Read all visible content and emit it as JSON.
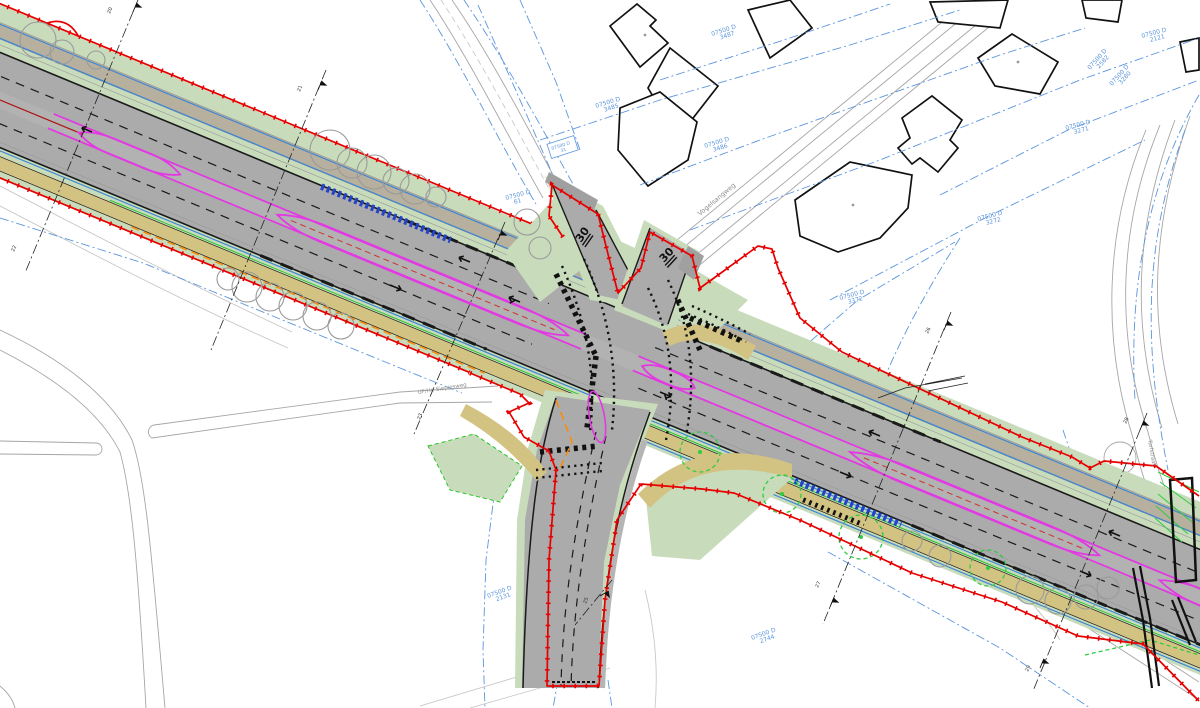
{
  "colors": {
    "boundary_red": "#e60000",
    "parcel_blue": "#5b95dd",
    "asphalt_gray": "#ababab",
    "verge_green": "#c8dcbc",
    "cycle_tan": "#d3c383",
    "footway_tan": "#b8b09e",
    "median_magenta": "#e23ae2",
    "utility_blue": "#3f87d2",
    "marking_orange": "#ff8a00",
    "tree_gray": "#9a9a9a",
    "tree_green": "#2ecc40",
    "chain_blue": "#2343c8",
    "existing_gray": "#a6a6a6",
    "building_black": "#111111"
  },
  "zone_signs": [
    "30",
    "30"
  ],
  "streets": {
    "main_side": "Vogelsangweg",
    "east": "Turfstraat"
  },
  "note": "UF/Hr. Siepiesweg",
  "parcels": [
    {
      "line1": "07500 D",
      "line2": "3487"
    },
    {
      "line1": "07500 D",
      "line2": "3485"
    },
    {
      "line1": "07500 D",
      "line2": "3486"
    },
    {
      "line1": "07500 D",
      "line2": "61"
    },
    {
      "line1": "07500 D",
      "line2": "2121"
    },
    {
      "line1": "07500 D",
      "line2": "2582"
    },
    {
      "line1": "07500 D",
      "line2": "3280"
    },
    {
      "line1": "07500 D",
      "line2": "3271"
    },
    {
      "line1": "07500 D",
      "line2": "3272"
    },
    {
      "line1": "07500 D",
      "line2": "3372"
    },
    {
      "line1": "07500 D",
      "line2": "2131"
    },
    {
      "line1": "07500 D",
      "line2": "2744"
    },
    {
      "line1": "07500 D",
      "line2": "31"
    }
  ],
  "stations": [
    "20",
    "21",
    "22",
    "23",
    "25",
    "26",
    "27",
    "28",
    "29"
  ]
}
